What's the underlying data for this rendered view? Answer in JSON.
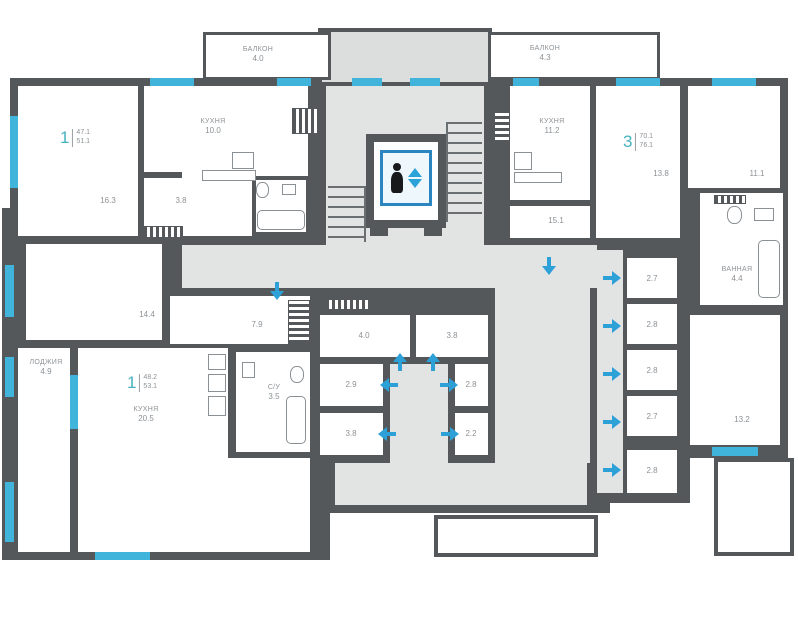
{
  "colors": {
    "wall": "#54585b",
    "corridor": "#e2e4e3",
    "window": "#41b4dc",
    "arrow": "#2da0d8",
    "apartment_number": "#45b2be",
    "label_text": "#8d9296"
  },
  "balconies": {
    "left": {
      "name": "БАЛКОН",
      "area": "4.0"
    },
    "right": {
      "name": "БАЛКОН",
      "area": "4.3"
    }
  },
  "apartments": {
    "top_left": {
      "num": "1",
      "area_living": "47.1",
      "area_total": "51.1",
      "kitchen_name": "КУХНЯ",
      "kitchen_area": "10.0",
      "room_area": "16.3",
      "hall_area": "3.8"
    },
    "top_right": {
      "num": "3",
      "area_living": "70.1",
      "area_total": "76.1",
      "kitchen_name": "КУХНЯ",
      "kitchen_area": "11.2",
      "room1_area": "13.8",
      "room2_area": "11.1",
      "room3_area": "13.2",
      "hall_area": "15.1",
      "bath_name": "ВАННАЯ",
      "bath_area": "4.4"
    },
    "bottom_left": {
      "num": "1",
      "area_living": "48.2",
      "area_total": "53.1",
      "kitchen_name": "КУХНЯ",
      "kitchen_area": "20.5",
      "room_area": "14.4",
      "hall_area": "7.9",
      "loggia_name": "ЛОДЖИЯ",
      "loggia_area": "4.9",
      "wc_name": "С/У",
      "wc_area": "3.5"
    }
  },
  "storage_center": {
    "a": "4.0",
    "b": "3.8",
    "c": "2.9",
    "d": "2.8",
    "e": "3.8",
    "f": "2.2"
  },
  "storage_right": {
    "r1": "2.7",
    "r2": "2.8",
    "r3": "2.8",
    "r4": "2.7",
    "r5": "2.8"
  }
}
